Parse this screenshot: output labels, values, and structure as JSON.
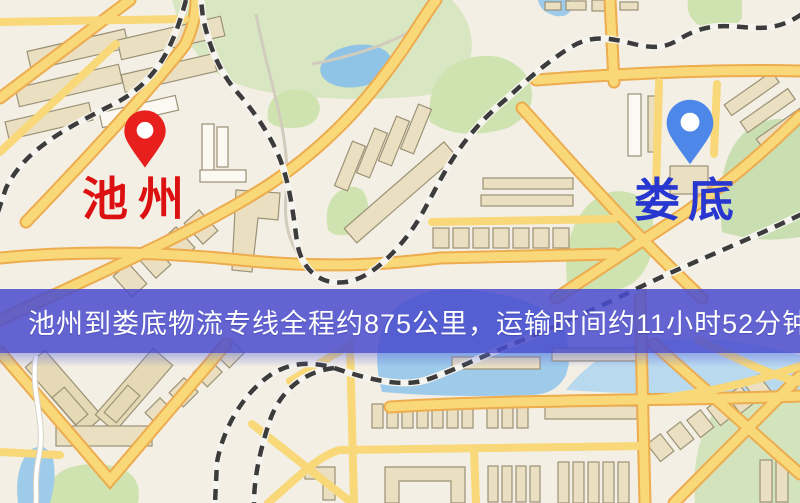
{
  "map": {
    "markers": [
      {
        "id": "origin",
        "label": "池州",
        "pin_color": "#e8201d",
        "label_color": "#dc1010"
      },
      {
        "id": "destination",
        "label": "娄底",
        "pin_color": "#4d87e8",
        "label_color": "#2737cf"
      }
    ],
    "banner": {
      "text": "池州到娄底物流专线全程约875公里，运输时间约11小时52分钟.",
      "background_color": "#4a4dce",
      "text_color": "#ffffff"
    },
    "palette": {
      "background": "#f4efe4",
      "road_fill": "#f8d878",
      "road_casing": "#edac4e",
      "park": "#cfe3b0",
      "water": "#9ecbea",
      "building": "#eadfc0",
      "railway_dark": "#3c3c3c",
      "railway_light": "#f6f4ee"
    }
  }
}
